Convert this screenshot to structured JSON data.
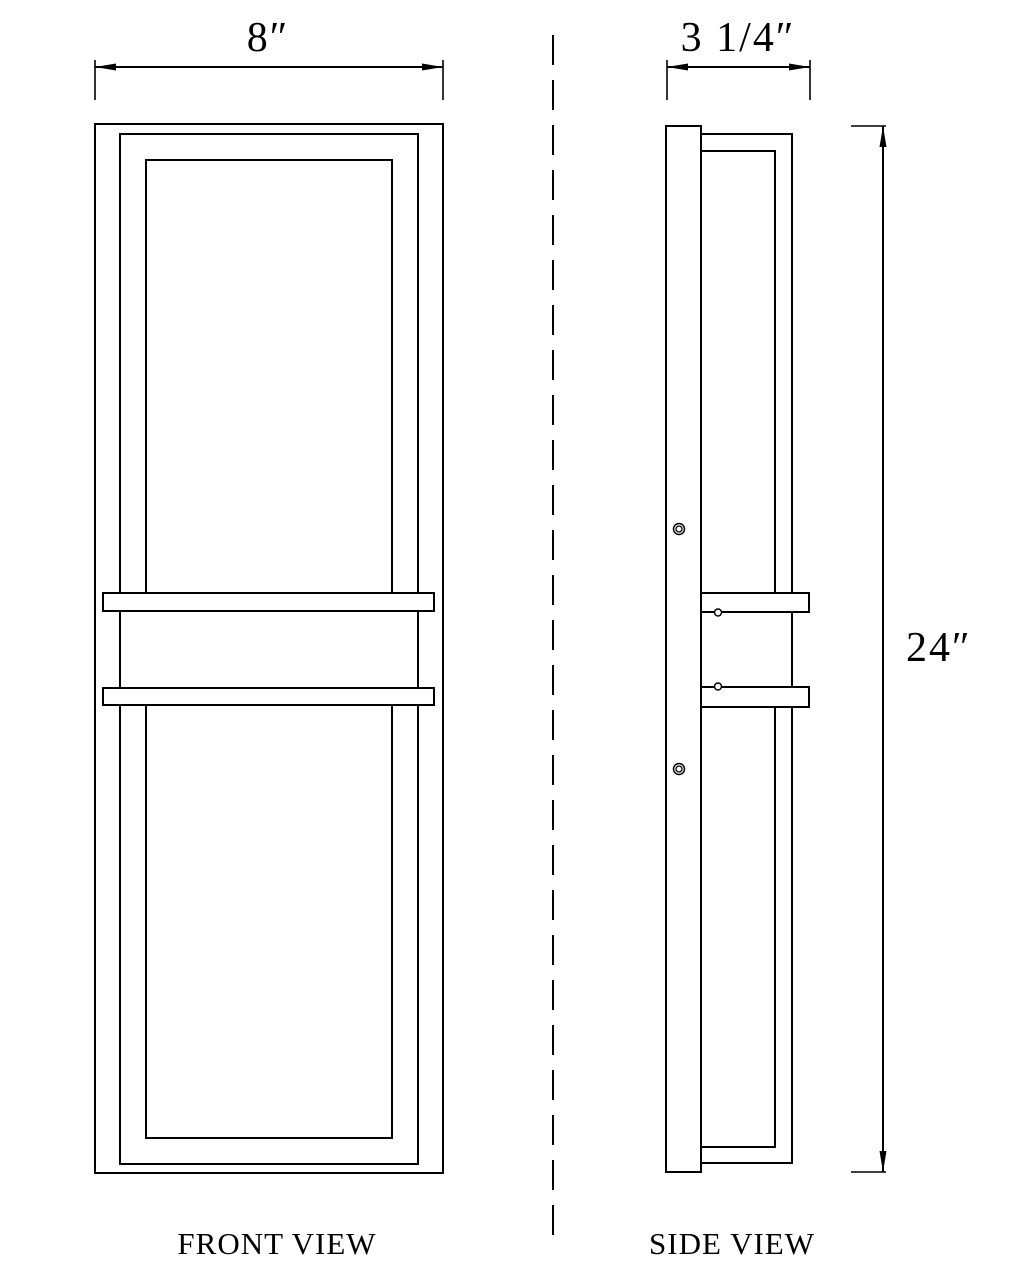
{
  "colors": {
    "line": "#000000",
    "background": "#ffffff"
  },
  "views": {
    "front": {
      "label": "FRONT VIEW"
    },
    "side": {
      "label": "SIDE VIEW"
    }
  },
  "dimensions": {
    "front_width": "8″",
    "side_depth": "3 1/4″",
    "height": "24″"
  }
}
